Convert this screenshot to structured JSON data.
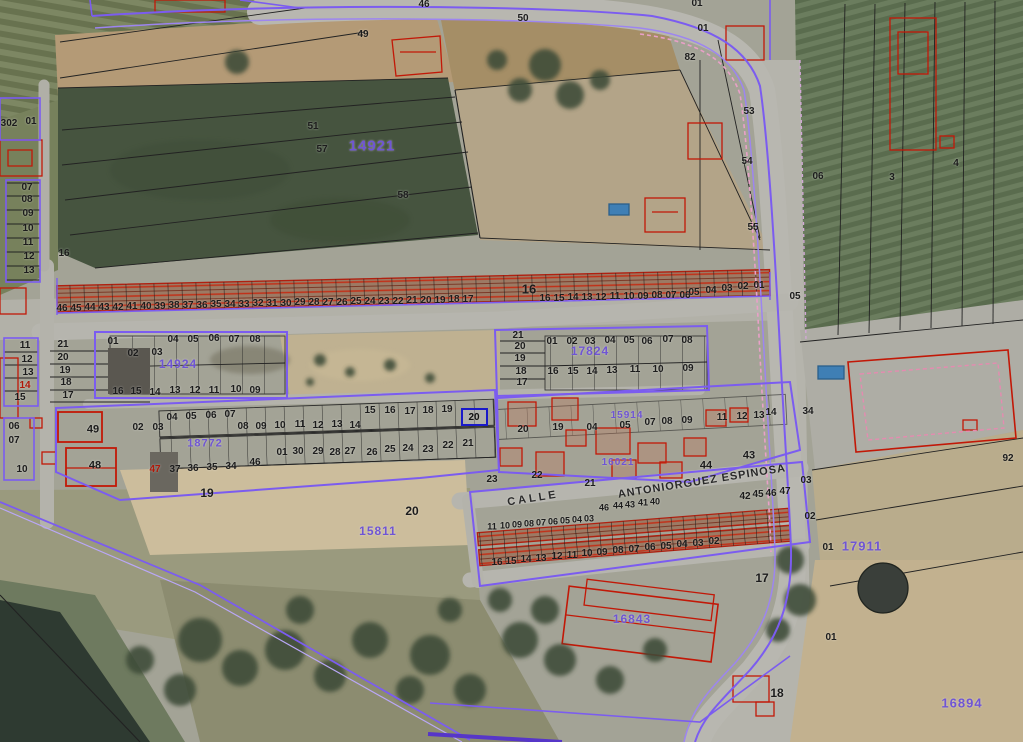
{
  "map": {
    "description": "Cadastral aerial parcel map with parcel numbers, block numbers and street name",
    "colors": {
      "black": "#1c1c1c",
      "purple": "#6f55d4",
      "red": "#b01808",
      "blue": "#1a1ac9"
    },
    "selected_parcel": {
      "label": "20",
      "x": 474,
      "y": 417,
      "w": 27,
      "h": 18
    },
    "street_labels": [
      {
        "t": "CALLE",
        "x": 533,
        "y": 499,
        "rot": -9,
        "ls": 3,
        "s": 11
      },
      {
        "t": "ANTONIORGUEZ  ESPINOSA",
        "x": 702,
        "y": 482,
        "rot": -9,
        "ls": 1,
        "s": 11
      }
    ],
    "block_labels": [
      {
        "t": "14921",
        "x": 372,
        "y": 146,
        "s": 15
      },
      {
        "t": "17911",
        "x": 862,
        "y": 546,
        "s": 13
      },
      {
        "t": "16894",
        "x": 962,
        "y": 703,
        "s": 13
      },
      {
        "t": "16843",
        "x": 632,
        "y": 619,
        "s": 12
      },
      {
        "t": "15811",
        "x": 378,
        "y": 531,
        "s": 12
      },
      {
        "t": "14924",
        "x": 178,
        "y": 364,
        "s": 12
      },
      {
        "t": "17824",
        "x": 590,
        "y": 351,
        "s": 12
      },
      {
        "t": "18772",
        "x": 205,
        "y": 444,
        "s": 11
      },
      {
        "t": "15914",
        "x": 627,
        "y": 416,
        "s": 10
      },
      {
        "t": "16021",
        "x": 618,
        "y": 463,
        "s": 10
      }
    ],
    "parcel_labels": [
      {
        "t": "302",
        "x": 9,
        "y": 124
      },
      {
        "t": "01",
        "x": 31,
        "y": 122
      },
      {
        "t": "07",
        "x": 27,
        "y": 188
      },
      {
        "t": "08",
        "x": 27,
        "y": 200
      },
      {
        "t": "09",
        "x": 28,
        "y": 214
      },
      {
        "t": "10",
        "x": 28,
        "y": 229
      },
      {
        "t": "11",
        "x": 28,
        "y": 243
      },
      {
        "t": "12",
        "x": 29,
        "y": 257
      },
      {
        "t": "13",
        "x": 29,
        "y": 271
      },
      {
        "t": "16",
        "x": 64,
        "y": 254
      },
      {
        "t": "49",
        "x": 363,
        "y": 35
      },
      {
        "t": "46",
        "x": 424,
        "y": 5
      },
      {
        "t": "50",
        "x": 523,
        "y": 19
      },
      {
        "t": "01",
        "x": 697,
        "y": 4
      },
      {
        "t": "01",
        "x": 703,
        "y": 29
      },
      {
        "t": "82",
        "x": 690,
        "y": 58
      },
      {
        "t": "51",
        "x": 313,
        "y": 127
      },
      {
        "t": "57",
        "x": 322,
        "y": 150
      },
      {
        "t": "58",
        "x": 403,
        "y": 196
      },
      {
        "t": "53",
        "x": 749,
        "y": 112
      },
      {
        "t": "54",
        "x": 747,
        "y": 162
      },
      {
        "t": "55",
        "x": 753,
        "y": 228
      },
      {
        "t": "06",
        "x": 818,
        "y": 177
      },
      {
        "t": "3",
        "x": 892,
        "y": 178
      },
      {
        "t": "4",
        "x": 956,
        "y": 164
      },
      {
        "t": "46",
        "x": 62,
        "y": 309
      },
      {
        "t": "45",
        "x": 76,
        "y": 309
      },
      {
        "t": "44",
        "x": 90,
        "y": 308
      },
      {
        "t": "43",
        "x": 104,
        "y": 308
      },
      {
        "t": "42",
        "x": 118,
        "y": 308
      },
      {
        "t": "41",
        "x": 132,
        "y": 307
      },
      {
        "t": "40",
        "x": 146,
        "y": 307
      },
      {
        "t": "39",
        "x": 160,
        "y": 307
      },
      {
        "t": "38",
        "x": 174,
        "y": 306
      },
      {
        "t": "37",
        "x": 188,
        "y": 306
      },
      {
        "t": "36",
        "x": 202,
        "y": 306
      },
      {
        "t": "35",
        "x": 216,
        "y": 305
      },
      {
        "t": "34",
        "x": 230,
        "y": 305
      },
      {
        "t": "33",
        "x": 244,
        "y": 305
      },
      {
        "t": "32",
        "x": 258,
        "y": 304
      },
      {
        "t": "31",
        "x": 272,
        "y": 304
      },
      {
        "t": "30",
        "x": 286,
        "y": 304
      },
      {
        "t": "29",
        "x": 300,
        "y": 303
      },
      {
        "t": "28",
        "x": 314,
        "y": 303
      },
      {
        "t": "27",
        "x": 328,
        "y": 303
      },
      {
        "t": "26",
        "x": 342,
        "y": 303
      },
      {
        "t": "25",
        "x": 356,
        "y": 302
      },
      {
        "t": "24",
        "x": 370,
        "y": 302
      },
      {
        "t": "23",
        "x": 384,
        "y": 302
      },
      {
        "t": "22",
        "x": 398,
        "y": 302
      },
      {
        "t": "21",
        "x": 412,
        "y": 301
      },
      {
        "t": "20",
        "x": 426,
        "y": 301
      },
      {
        "t": "19",
        "x": 440,
        "y": 301
      },
      {
        "t": "18",
        "x": 454,
        "y": 300
      },
      {
        "t": "17",
        "x": 468,
        "y": 300
      },
      {
        "t": "16",
        "x": 529,
        "y": 289,
        "s": 13
      },
      {
        "t": "16",
        "x": 545,
        "y": 299
      },
      {
        "t": "15",
        "x": 559,
        "y": 299
      },
      {
        "t": "14",
        "x": 573,
        "y": 298
      },
      {
        "t": "13",
        "x": 587,
        "y": 298
      },
      {
        "t": "12",
        "x": 601,
        "y": 298
      },
      {
        "t": "11",
        "x": 615,
        "y": 297
      },
      {
        "t": "10",
        "x": 629,
        "y": 297
      },
      {
        "t": "09",
        "x": 643,
        "y": 297
      },
      {
        "t": "08",
        "x": 657,
        "y": 296
      },
      {
        "t": "07",
        "x": 671,
        "y": 296
      },
      {
        "t": "06",
        "x": 685,
        "y": 296
      },
      {
        "t": "05",
        "x": 694,
        "y": 293
      },
      {
        "t": "04",
        "x": 711,
        "y": 291
      },
      {
        "t": "03",
        "x": 727,
        "y": 289
      },
      {
        "t": "02",
        "x": 743,
        "y": 287
      },
      {
        "t": "01",
        "x": 759,
        "y": 286
      },
      {
        "t": "05",
        "x": 795,
        "y": 297
      },
      {
        "t": "11",
        "x": 25,
        "y": 346
      },
      {
        "t": "12",
        "x": 27,
        "y": 360
      },
      {
        "t": "13",
        "x": 28,
        "y": 373
      },
      {
        "t": "14",
        "x": 25,
        "y": 386,
        "c": "red"
      },
      {
        "t": "15",
        "x": 20,
        "y": 398
      },
      {
        "t": "21",
        "x": 63,
        "y": 345
      },
      {
        "t": "20",
        "x": 63,
        "y": 358
      },
      {
        "t": "19",
        "x": 65,
        "y": 371
      },
      {
        "t": "18",
        "x": 66,
        "y": 383
      },
      {
        "t": "17",
        "x": 68,
        "y": 396
      },
      {
        "t": "01",
        "x": 113,
        "y": 342
      },
      {
        "t": "02",
        "x": 133,
        "y": 354
      },
      {
        "t": "03",
        "x": 157,
        "y": 353
      },
      {
        "t": "04",
        "x": 173,
        "y": 340
      },
      {
        "t": "05",
        "x": 193,
        "y": 340
      },
      {
        "t": "06",
        "x": 214,
        "y": 339
      },
      {
        "t": "07",
        "x": 234,
        "y": 340
      },
      {
        "t": "08",
        "x": 255,
        "y": 340
      },
      {
        "t": "16",
        "x": 118,
        "y": 392
      },
      {
        "t": "15",
        "x": 136,
        "y": 392
      },
      {
        "t": "14",
        "x": 155,
        "y": 393
      },
      {
        "t": "13",
        "x": 175,
        "y": 391
      },
      {
        "t": "12",
        "x": 195,
        "y": 391
      },
      {
        "t": "11",
        "x": 214,
        "y": 391
      },
      {
        "t": "10",
        "x": 236,
        "y": 390
      },
      {
        "t": "09",
        "x": 255,
        "y": 391
      },
      {
        "t": "21",
        "x": 518,
        "y": 336
      },
      {
        "t": "20",
        "x": 520,
        "y": 347
      },
      {
        "t": "19",
        "x": 520,
        "y": 359
      },
      {
        "t": "18",
        "x": 521,
        "y": 372
      },
      {
        "t": "17",
        "x": 522,
        "y": 383
      },
      {
        "t": "01",
        "x": 552,
        "y": 342
      },
      {
        "t": "02",
        "x": 572,
        "y": 342
      },
      {
        "t": "03",
        "x": 590,
        "y": 342
      },
      {
        "t": "04",
        "x": 610,
        "y": 341
      },
      {
        "t": "05",
        "x": 629,
        "y": 341
      },
      {
        "t": "06",
        "x": 647,
        "y": 342
      },
      {
        "t": "07",
        "x": 668,
        "y": 340
      },
      {
        "t": "08",
        "x": 687,
        "y": 341
      },
      {
        "t": "16",
        "x": 553,
        "y": 372
      },
      {
        "t": "15",
        "x": 573,
        "y": 372
      },
      {
        "t": "14",
        "x": 592,
        "y": 372
      },
      {
        "t": "13",
        "x": 612,
        "y": 371
      },
      {
        "t": "11",
        "x": 635,
        "y": 370
      },
      {
        "t": "10",
        "x": 658,
        "y": 370
      },
      {
        "t": "09",
        "x": 688,
        "y": 369
      },
      {
        "t": "06",
        "x": 14,
        "y": 427
      },
      {
        "t": "07",
        "x": 14,
        "y": 441
      },
      {
        "t": "10",
        "x": 22,
        "y": 470
      },
      {
        "t": "49",
        "x": 93,
        "y": 430,
        "s": 11
      },
      {
        "t": "48",
        "x": 95,
        "y": 466,
        "s": 11
      },
      {
        "t": "02",
        "x": 138,
        "y": 428
      },
      {
        "t": "03",
        "x": 158,
        "y": 428
      },
      {
        "t": "04",
        "x": 172,
        "y": 418
      },
      {
        "t": "05",
        "x": 191,
        "y": 417
      },
      {
        "t": "06",
        "x": 211,
        "y": 416
      },
      {
        "t": "07",
        "x": 230,
        "y": 415
      },
      {
        "t": "08",
        "x": 243,
        "y": 427
      },
      {
        "t": "09",
        "x": 261,
        "y": 427
      },
      {
        "t": "10",
        "x": 280,
        "y": 426
      },
      {
        "t": "11",
        "x": 300,
        "y": 425
      },
      {
        "t": "12",
        "x": 318,
        "y": 426
      },
      {
        "t": "13",
        "x": 337,
        "y": 425
      },
      {
        "t": "14",
        "x": 355,
        "y": 426
      },
      {
        "t": "15",
        "x": 370,
        "y": 411
      },
      {
        "t": "16",
        "x": 390,
        "y": 411
      },
      {
        "t": "17",
        "x": 410,
        "y": 412
      },
      {
        "t": "18",
        "x": 428,
        "y": 411
      },
      {
        "t": "19",
        "x": 447,
        "y": 410
      },
      {
        "t": "30",
        "x": 298,
        "y": 452
      },
      {
        "t": "29",
        "x": 318,
        "y": 452
      },
      {
        "t": "28",
        "x": 335,
        "y": 453
      },
      {
        "t": "27",
        "x": 350,
        "y": 452
      },
      {
        "t": "26",
        "x": 372,
        "y": 453
      },
      {
        "t": "25",
        "x": 390,
        "y": 450
      },
      {
        "t": "24",
        "x": 408,
        "y": 449
      },
      {
        "t": "23",
        "x": 428,
        "y": 450
      },
      {
        "t": "22",
        "x": 448,
        "y": 446
      },
      {
        "t": "21",
        "x": 468,
        "y": 444
      },
      {
        "t": "46",
        "x": 255,
        "y": 463
      },
      {
        "t": "01",
        "x": 282,
        "y": 453
      },
      {
        "t": "47",
        "x": 155,
        "y": 470,
        "c": "red"
      },
      {
        "t": "37",
        "x": 175,
        "y": 470
      },
      {
        "t": "36",
        "x": 193,
        "y": 469
      },
      {
        "t": "35",
        "x": 212,
        "y": 468
      },
      {
        "t": "34",
        "x": 231,
        "y": 467
      },
      {
        "t": "19",
        "x": 207,
        "y": 493,
        "s": 12
      },
      {
        "t": "20",
        "x": 412,
        "y": 511,
        "s": 12
      },
      {
        "t": "23",
        "x": 492,
        "y": 480
      },
      {
        "t": "20",
        "x": 523,
        "y": 430
      },
      {
        "t": "19",
        "x": 558,
        "y": 428
      },
      {
        "t": "04",
        "x": 592,
        "y": 428
      },
      {
        "t": "05",
        "x": 625,
        "y": 426
      },
      {
        "t": "07",
        "x": 650,
        "y": 423
      },
      {
        "t": "08",
        "x": 667,
        "y": 422
      },
      {
        "t": "09",
        "x": 687,
        "y": 421
      },
      {
        "t": "11",
        "x": 722,
        "y": 418
      },
      {
        "t": "12",
        "x": 742,
        "y": 417
      },
      {
        "t": "13",
        "x": 759,
        "y": 416
      },
      {
        "t": "14",
        "x": 771,
        "y": 413
      },
      {
        "t": "22",
        "x": 537,
        "y": 476
      },
      {
        "t": "21",
        "x": 590,
        "y": 484
      },
      {
        "t": "44",
        "x": 706,
        "y": 466,
        "s": 11
      },
      {
        "t": "43",
        "x": 749,
        "y": 456,
        "s": 11
      },
      {
        "t": "46",
        "x": 604,
        "y": 508,
        "s": 9
      },
      {
        "t": "44",
        "x": 618,
        "y": 506,
        "s": 9
      },
      {
        "t": "43",
        "x": 630,
        "y": 505,
        "s": 9
      },
      {
        "t": "41",
        "x": 643,
        "y": 503,
        "s": 9
      },
      {
        "t": "40",
        "x": 655,
        "y": 502,
        "s": 9
      },
      {
        "t": "42",
        "x": 745,
        "y": 497
      },
      {
        "t": "45",
        "x": 758,
        "y": 495
      },
      {
        "t": "46",
        "x": 771,
        "y": 494
      },
      {
        "t": "47",
        "x": 785,
        "y": 492
      },
      {
        "t": "11",
        "x": 492,
        "y": 527,
        "s": 9
      },
      {
        "t": "10",
        "x": 505,
        "y": 526,
        "s": 9
      },
      {
        "t": "09",
        "x": 517,
        "y": 525,
        "s": 9
      },
      {
        "t": "08",
        "x": 529,
        "y": 524,
        "s": 9
      },
      {
        "t": "07",
        "x": 541,
        "y": 523,
        "s": 9
      },
      {
        "t": "06",
        "x": 553,
        "y": 522,
        "s": 9
      },
      {
        "t": "05",
        "x": 565,
        "y": 521,
        "s": 9
      },
      {
        "t": "04",
        "x": 577,
        "y": 520,
        "s": 9
      },
      {
        "t": "03",
        "x": 589,
        "y": 519,
        "s": 9
      },
      {
        "t": "16",
        "x": 497,
        "y": 563
      },
      {
        "t": "15",
        "x": 511,
        "y": 562
      },
      {
        "t": "14",
        "x": 526,
        "y": 560
      },
      {
        "t": "13",
        "x": 541,
        "y": 559
      },
      {
        "t": "12",
        "x": 557,
        "y": 557
      },
      {
        "t": "11",
        "x": 572,
        "y": 556
      },
      {
        "t": "10",
        "x": 587,
        "y": 554
      },
      {
        "t": "09",
        "x": 602,
        "y": 553
      },
      {
        "t": "08",
        "x": 618,
        "y": 551
      },
      {
        "t": "07",
        "x": 634,
        "y": 550
      },
      {
        "t": "06",
        "x": 650,
        "y": 548
      },
      {
        "t": "05",
        "x": 666,
        "y": 547
      },
      {
        "t": "04",
        "x": 682,
        "y": 545
      },
      {
        "t": "03",
        "x": 698,
        "y": 544
      },
      {
        "t": "02",
        "x": 714,
        "y": 542
      },
      {
        "t": "34",
        "x": 808,
        "y": 412
      },
      {
        "t": "03",
        "x": 806,
        "y": 481
      },
      {
        "t": "02",
        "x": 810,
        "y": 517
      },
      {
        "t": "01",
        "x": 828,
        "y": 548
      },
      {
        "t": "92",
        "x": 1008,
        "y": 459
      },
      {
        "t": "17",
        "x": 762,
        "y": 578,
        "s": 12
      },
      {
        "t": "18",
        "x": 777,
        "y": 693,
        "s": 12
      },
      {
        "t": "01",
        "x": 831,
        "y": 638
      }
    ]
  }
}
